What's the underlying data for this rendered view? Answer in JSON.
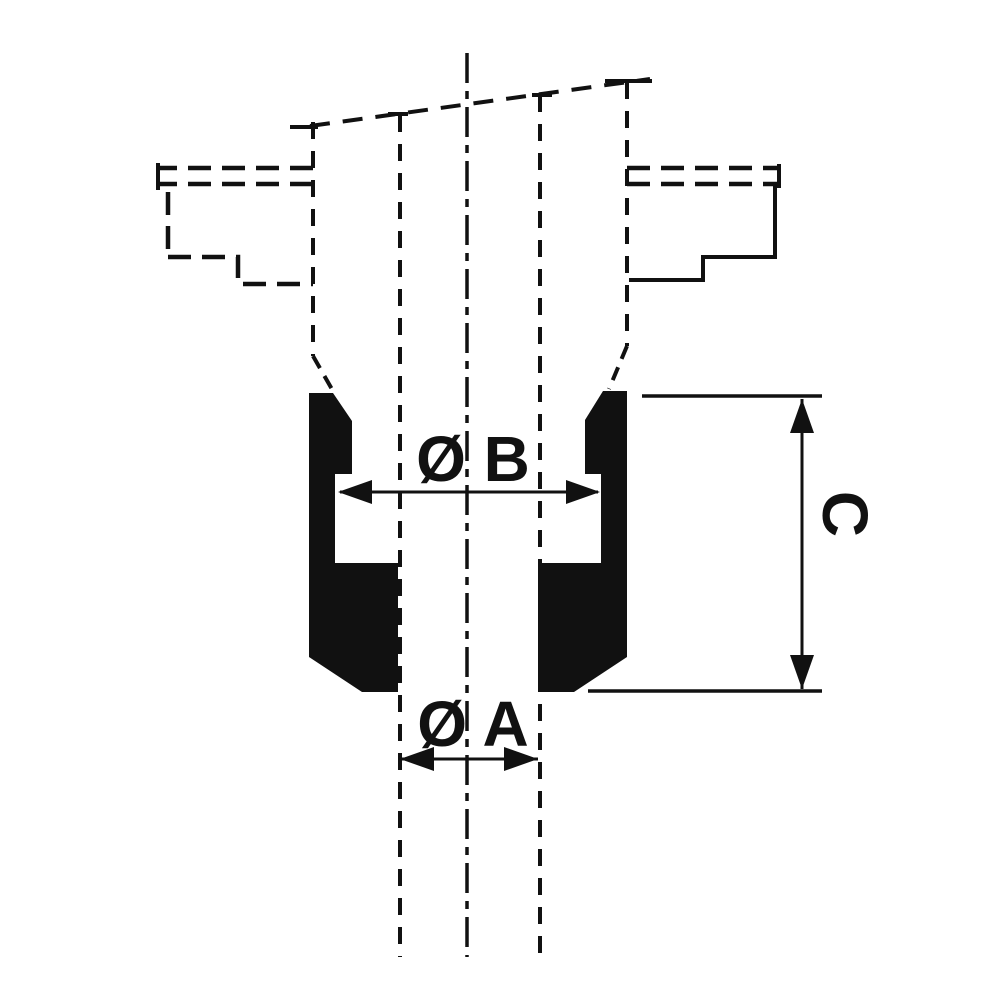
{
  "diagram": {
    "type": "technical-section-drawing",
    "subject": "cable grommet cross-section with mounting panel hidden outline",
    "labels": {
      "diameter_b": "Ø B",
      "diameter_a": "Ø A",
      "height_c": "C"
    },
    "colors": {
      "line": "#111111",
      "background": "#ffffff"
    }
  }
}
